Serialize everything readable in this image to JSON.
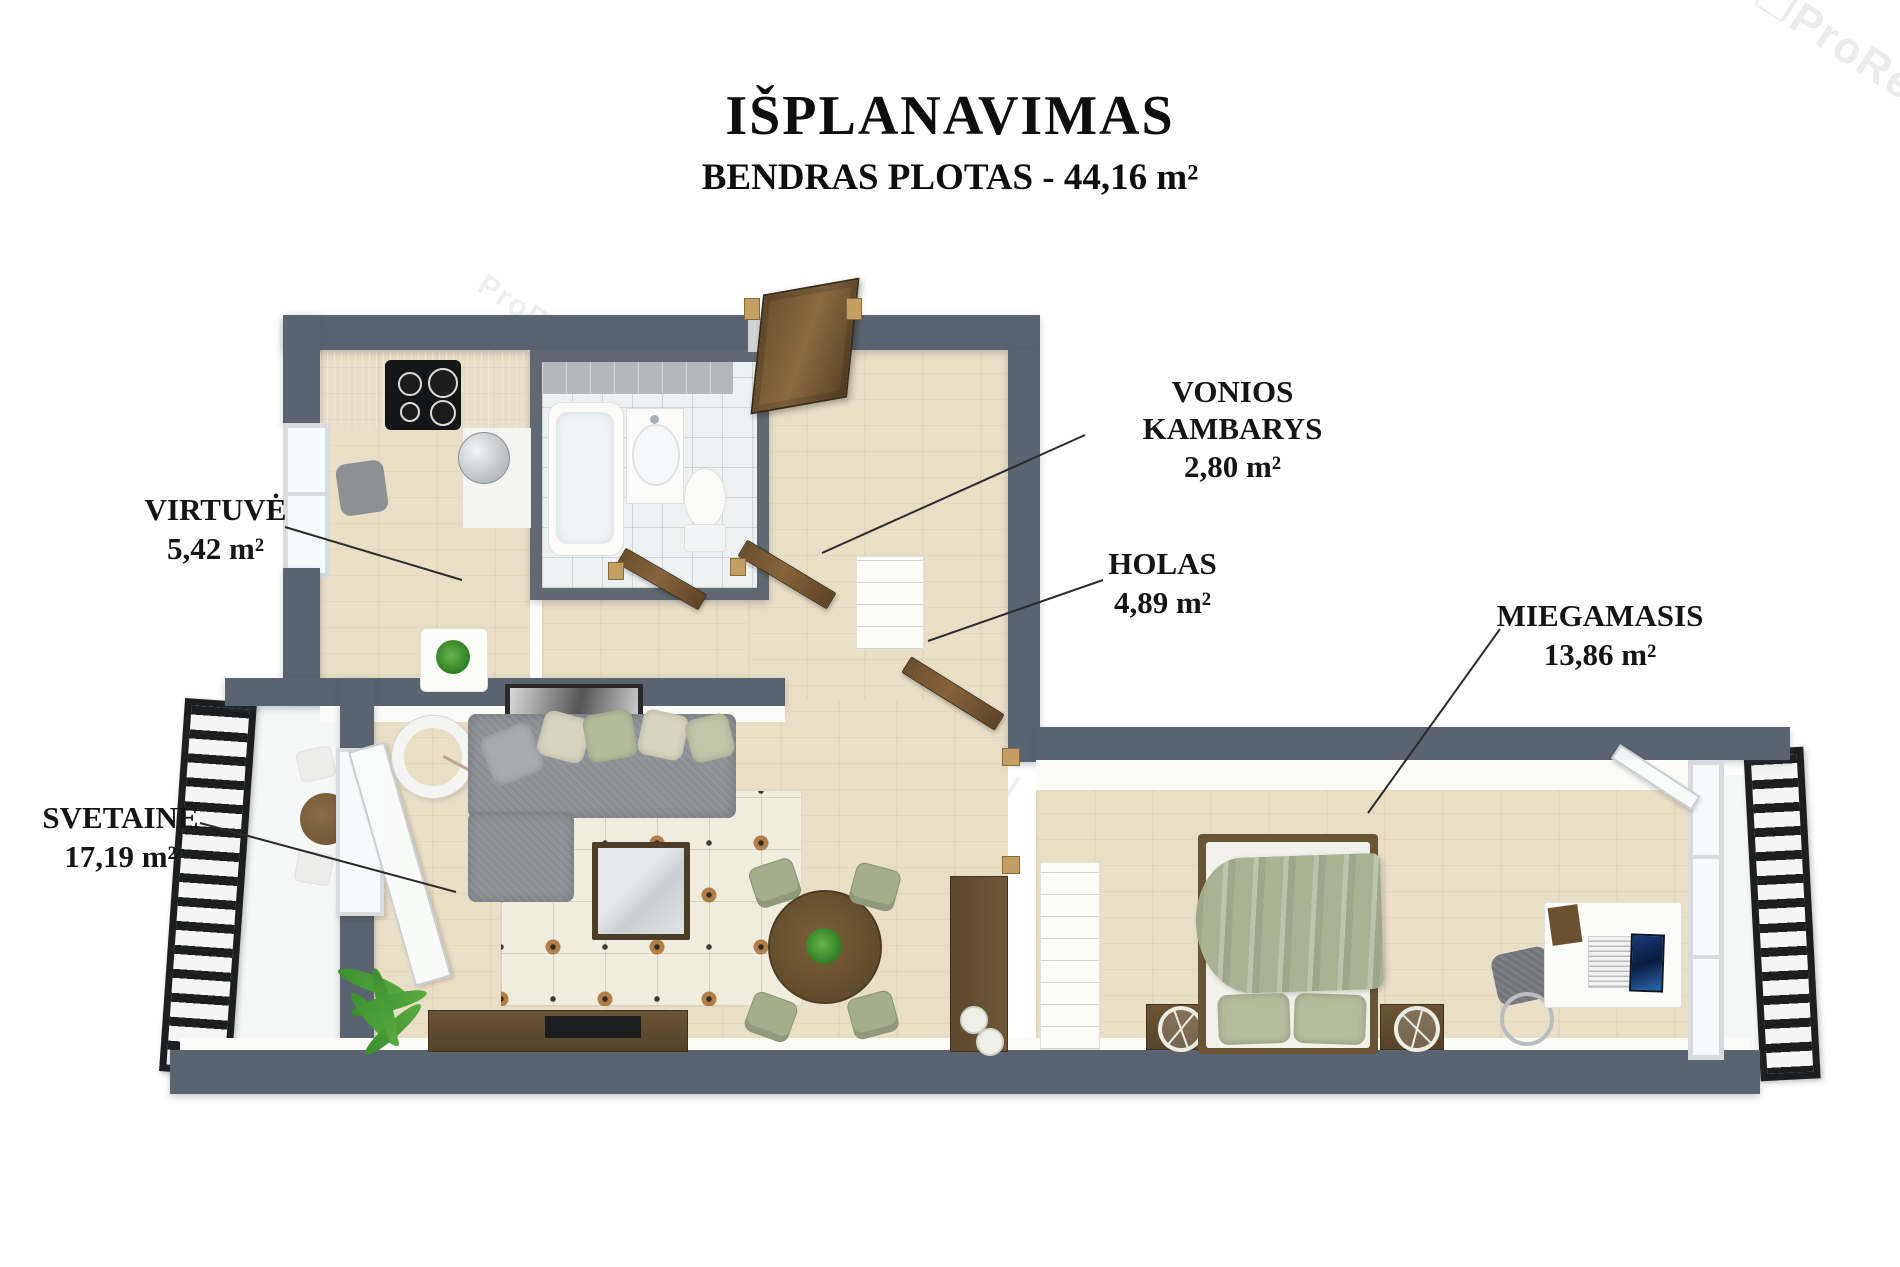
{
  "header": {
    "title": "IŠPLANAVIMAS",
    "subtitle": "BENDRAS PLOTAS - 44,16 m²"
  },
  "rooms": [
    {
      "name": "VIRTUVĖ",
      "area": "5,42 m²"
    },
    {
      "name": "VONIOS KAMBARYS",
      "area": "2,80 m²"
    },
    {
      "name": "HOLAS",
      "area": "4,89 m²"
    },
    {
      "name": "MIEGAMASIS",
      "area": "13,86 m²"
    },
    {
      "name": "SVETAINĖ",
      "area": "17,19 m²"
    }
  ],
  "watermark": {
    "glyph": "❐",
    "brand": "ProReal"
  },
  "colors": {
    "wall": "#5a6470",
    "wood_floor": "#e9dec6",
    "railing": "#1c1e20",
    "door": "#7a5c36",
    "blanket_green": "#a9b394",
    "label_text": "#151515"
  }
}
